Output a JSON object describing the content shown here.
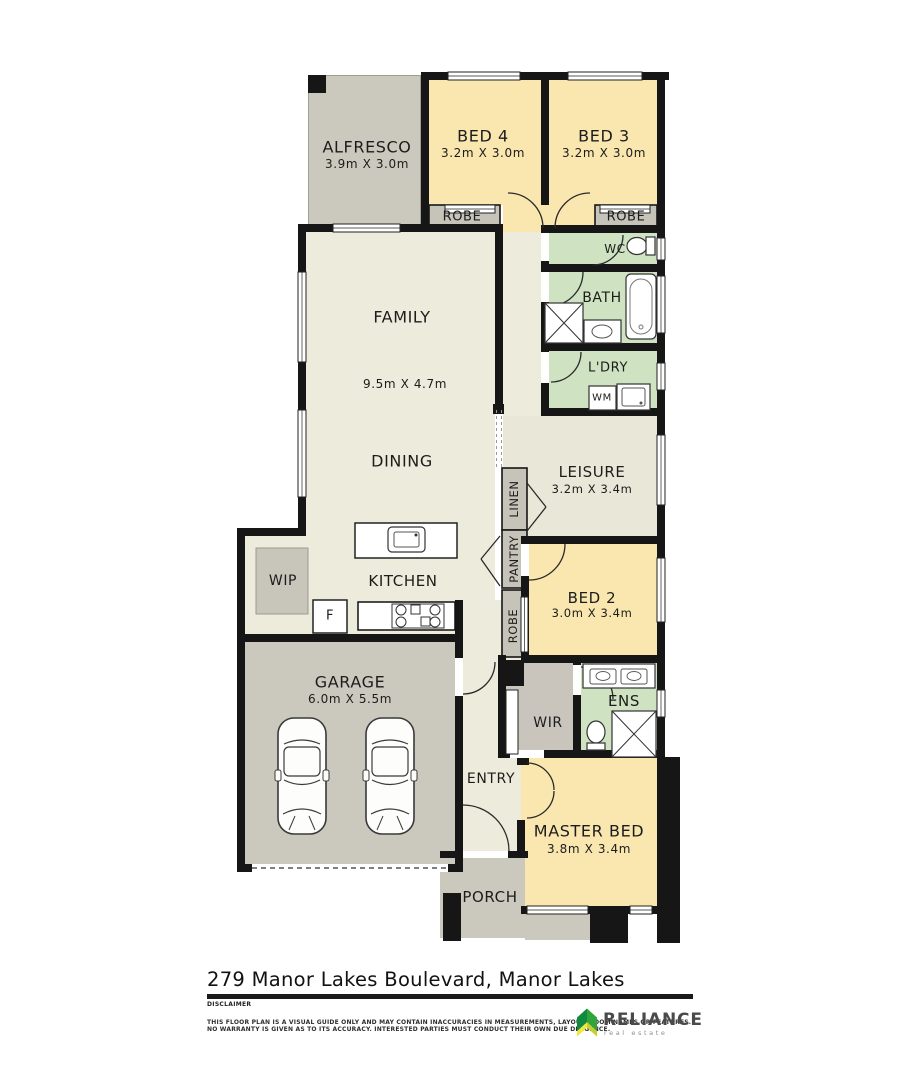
{
  "plan": {
    "rooms": {
      "alfresco": {
        "name": "ALFRESCO",
        "dims": "3.9m X 3.0m"
      },
      "bed4": {
        "name": "BED 4",
        "dims": "3.2m X 3.0m"
      },
      "bed3": {
        "name": "BED 3",
        "dims": "3.2m X 3.0m"
      },
      "robe_bed4": {
        "name": "ROBE"
      },
      "robe_bed3": {
        "name": "ROBE"
      },
      "wc": {
        "name": "WC"
      },
      "bath": {
        "name": "BATH"
      },
      "laundry": {
        "name": "L'DRY"
      },
      "wm": {
        "name": "WM"
      },
      "family": {
        "name": "FAMILY",
        "dims": "9.5m X 4.7m"
      },
      "dining": {
        "name": "DINING"
      },
      "kitchen": {
        "name": "KITCHEN"
      },
      "wip": {
        "name": "WIP"
      },
      "fridge": {
        "name": "F"
      },
      "linen": {
        "name": "LINEN"
      },
      "pantry": {
        "name": "PANTRY"
      },
      "robe_bed2": {
        "name": "ROBE"
      },
      "leisure": {
        "name": "LEISURE",
        "dims": "3.2m X 3.4m"
      },
      "bed2": {
        "name": "BED 2",
        "dims": "3.0m X 3.4m"
      },
      "garage": {
        "name": "GARAGE",
        "dims": "6.0m X 5.5m"
      },
      "wir": {
        "name": "WIR"
      },
      "ens": {
        "name": "ENS"
      },
      "entry": {
        "name": "ENTRY"
      },
      "master": {
        "name": "MASTER BED",
        "dims": "3.8m X 3.4m"
      },
      "porch": {
        "name": "PORCH"
      }
    },
    "colors": {
      "bedroom": "#F9E7AF",
      "wet_area": "#CFE3C2",
      "living": "#EDEBDB",
      "outdoor": "#CBC8BD",
      "cupboard": "#C6C3B9",
      "wall": "#161616"
    }
  },
  "footer": {
    "address": "279 Manor Lakes Boulevard, Manor Lakes",
    "disclaimer_title": "DISCLAIMER",
    "disclaimer_line1": "THIS FLOOR PLAN IS A VISUAL GUIDE ONLY AND MAY CONTAIN INACCURACIES IN MEASUREMENTS, LAYOUT, ROOM NAMES OR FEATURES.",
    "disclaimer_line2": "NO WARRANTY IS GIVEN AS TO ITS ACCURACY. INTERESTED PARTIES MUST CONDUCT THEIR OWN DUE DILIGENCE.",
    "brand": {
      "name": "RELIANCE",
      "tagline": "real estate",
      "green_dark": "#0F8A3E",
      "green_light": "#31A43A",
      "yellow": "#F2E83C"
    }
  }
}
